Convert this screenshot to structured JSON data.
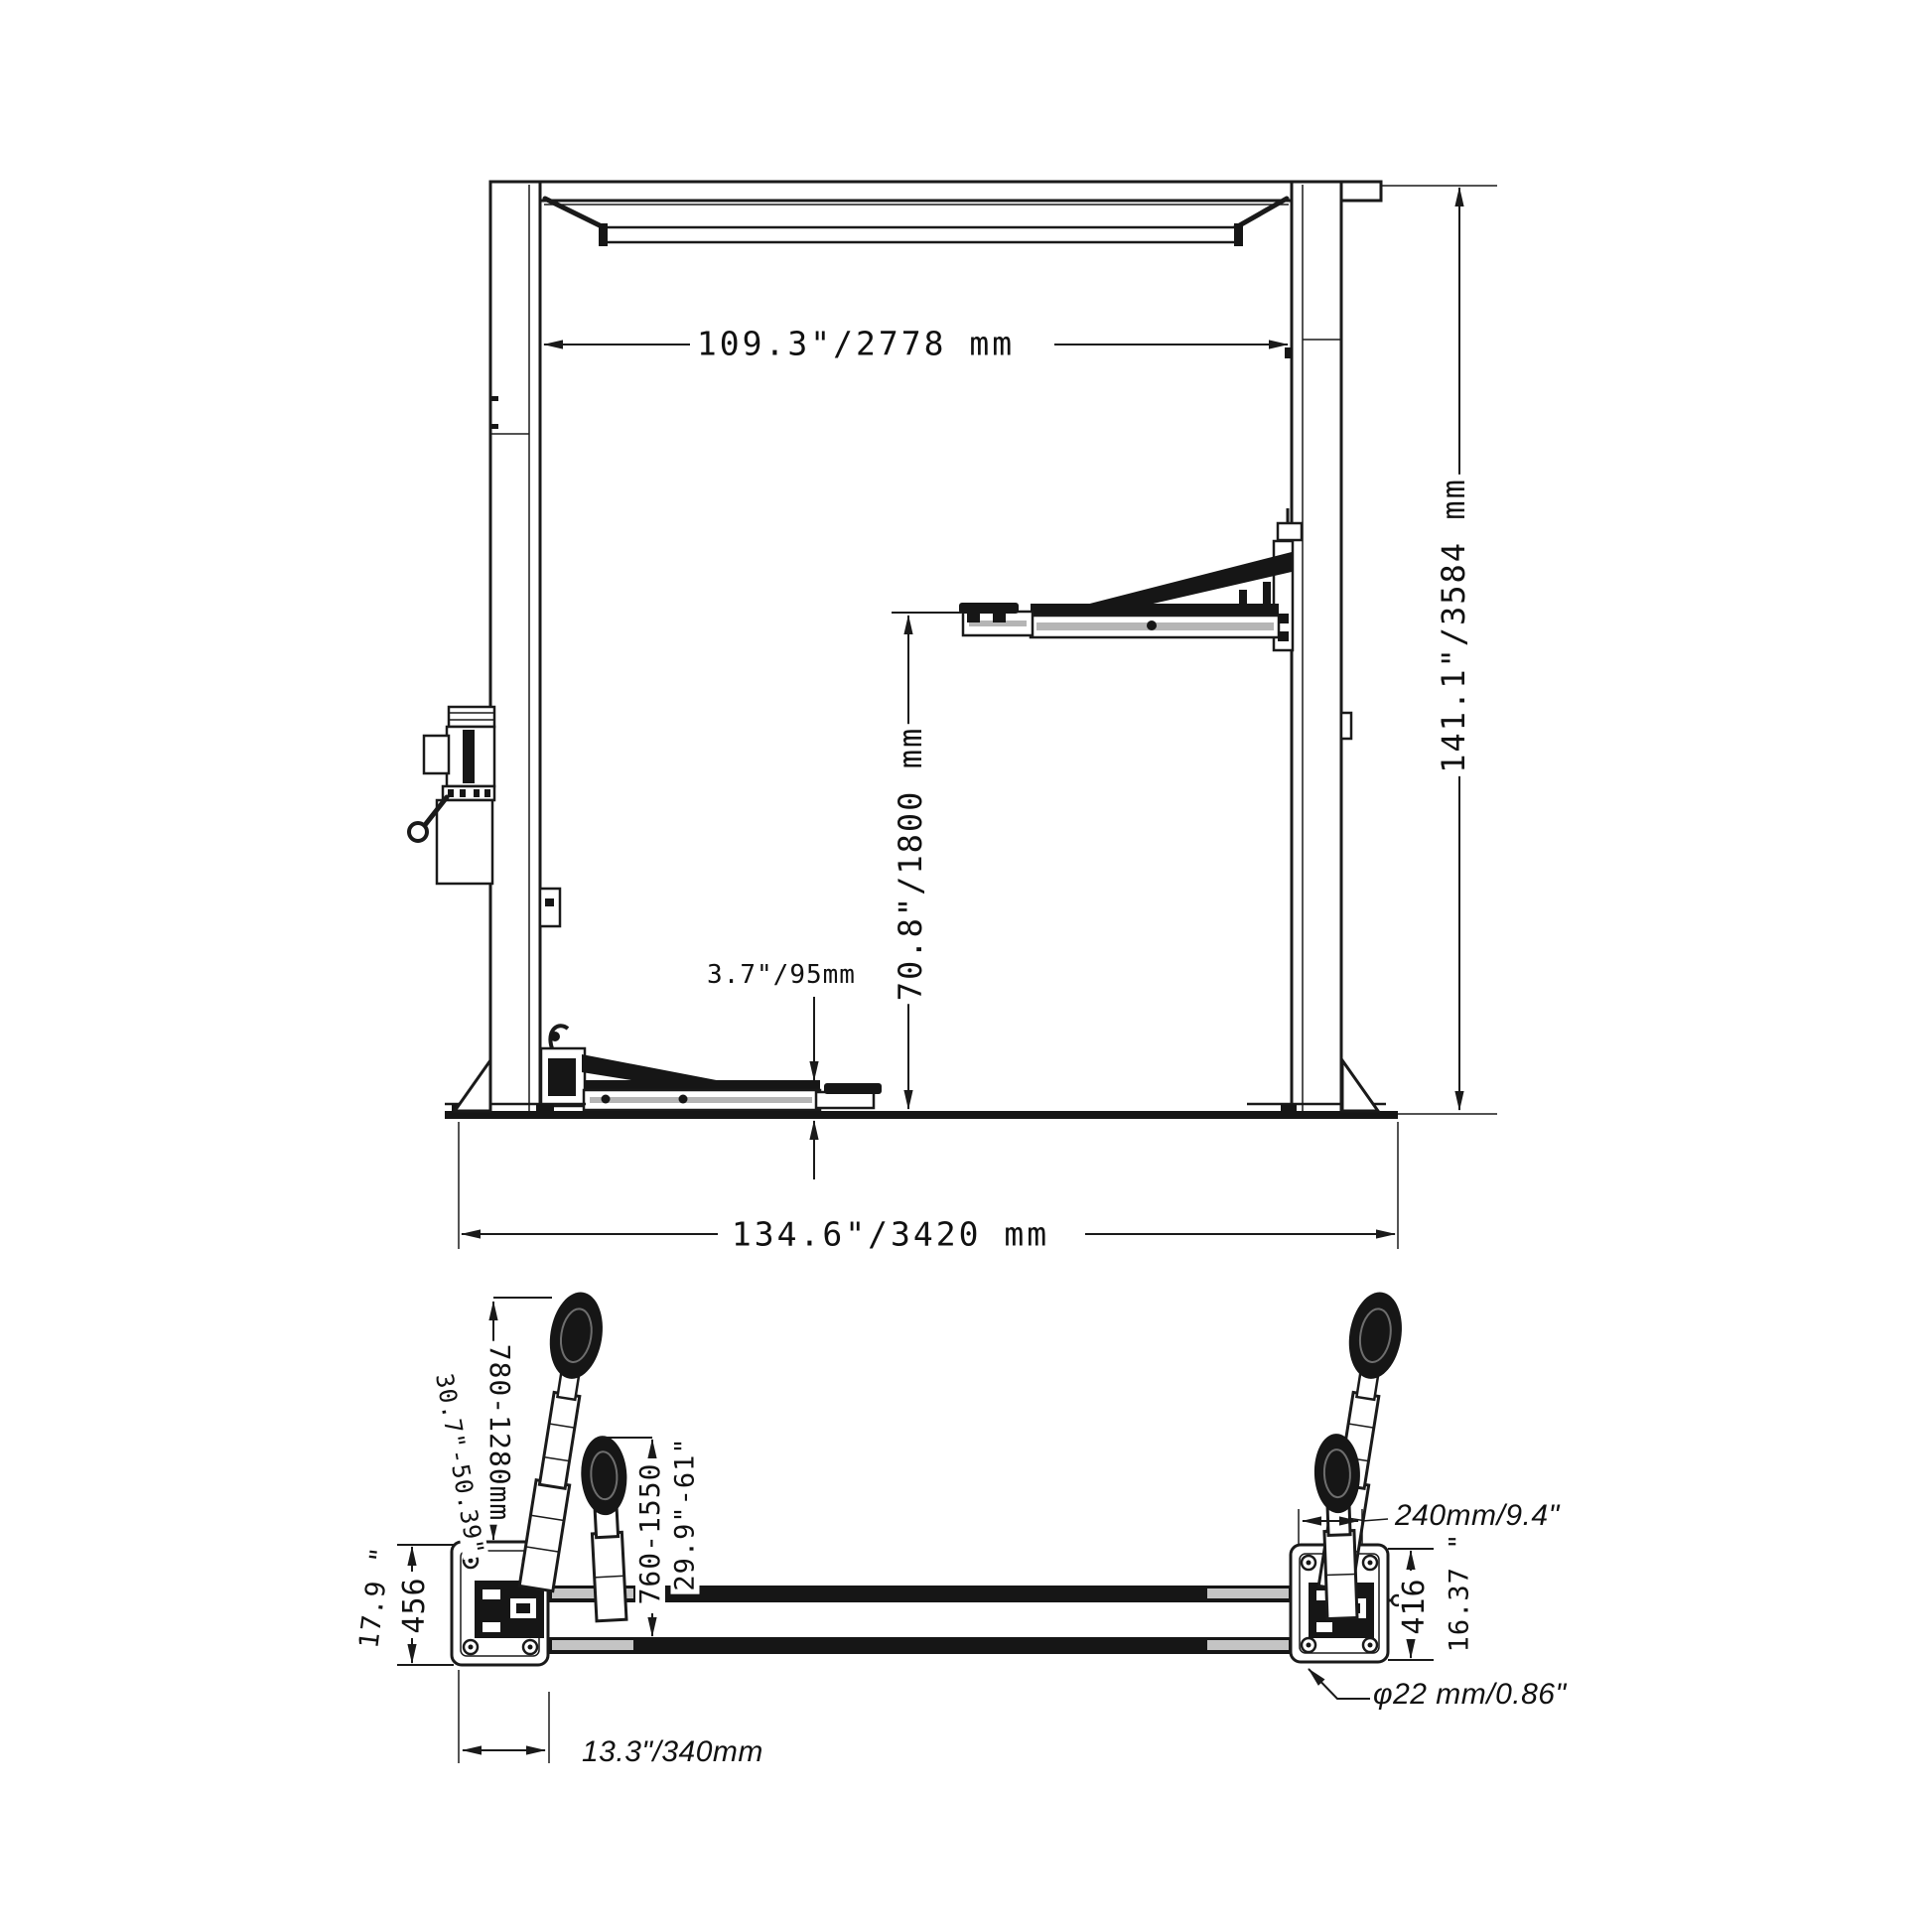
{
  "colors": {
    "background": "#ffffff",
    "line": "#1a1a1a"
  },
  "labels": {
    "top_width": "109.3\"/2778 mm",
    "total_height": "141.1\"/3584 mm",
    "lift_height": "70.8\"/1800 mm",
    "min_pad_height": "3.7\"/95mm",
    "base_width": "134.6\"/3420 mm",
    "arm_range_long_mm": "780-1280mm",
    "arm_range_long_in": "30.7\"-50.39\"",
    "arm_range_short_mm": "760-1550",
    "arm_range_short_in": "29.9\"-61\"",
    "left_plate_in": "17.9 \"",
    "left_plate_mm": "456",
    "carriage_width": "240mm/9.4\"",
    "right_plate_mm": "416",
    "right_plate_in": "16.37 \"",
    "anchor_bolt_dia": "φ22 mm/0.86\"",
    "plate_width": "13.3\"/340mm"
  }
}
